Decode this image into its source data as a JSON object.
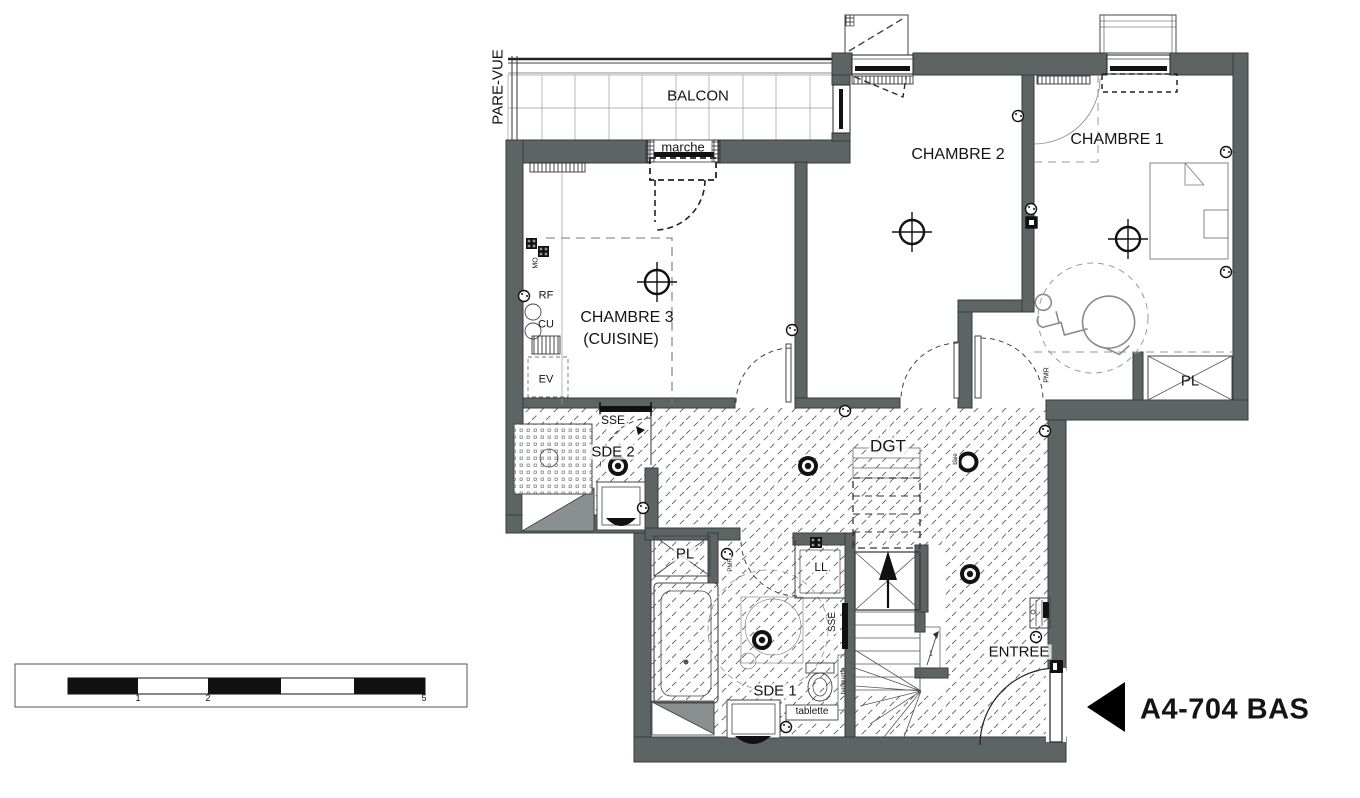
{
  "plan_reference": {
    "label": "A4-704 BAS"
  },
  "rooms": {
    "balcon": "BALCON",
    "chambre_1": "CHAMBRE 1",
    "chambre_2": "CHAMBRE 2",
    "chambre_3_line1": "CHAMBRE 3",
    "chambre_3_line2": "(CUISINE)",
    "sde_1": "SDE 1",
    "sde_2": "SDE 2",
    "degagement": "DGT",
    "entree": "ENTREE",
    "placard_chambre_1": "PL",
    "placard_sde_1": "PL"
  },
  "annotations": {
    "pare_vue": "PARE-VUE",
    "marche": "marche",
    "micro_onde": "MO",
    "refrigerateur": "RF",
    "cuisson": "CU",
    "evier": "EV",
    "sse_sde_2": "SSE",
    "sse_stairs": "SSE",
    "lave_linge": "LL",
    "banquette": "banquette",
    "tablette": "tablette",
    "pmr_chambre_1": "PMR",
    "pmr_sde_1": "PMR",
    "baie": "baie",
    "stair_flight_number": "1"
  },
  "scale_bar": {
    "ticks": [
      "1",
      "2",
      "5"
    ]
  },
  "icons": {
    "ceiling_light": "crossed-circle",
    "spotlight": "double-ring",
    "socket": "small-circle",
    "stairs_up_arrow": "up-arrow",
    "plan_direction_pointer": "left-black-triangle",
    "wheelchair": "pmr-turning-symbol"
  },
  "colors": {
    "wall_fill": "#5d6464",
    "wall_outline": "#353b3b",
    "hatch_line": "#5f5f5f",
    "text": "#141414"
  }
}
